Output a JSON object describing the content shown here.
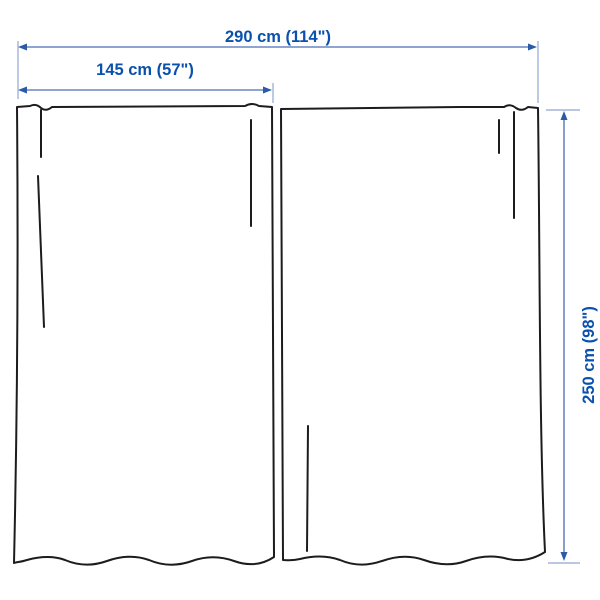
{
  "diagram": {
    "type": "product-dimension-illustration",
    "subject": "pair of curtain panels",
    "dimensions": {
      "total_width": {
        "label": "290 cm (114\")",
        "cm": 290,
        "inches": 114,
        "orientation": "horizontal"
      },
      "panel_width": {
        "label": "145 cm (57\")",
        "cm": 145,
        "inches": 57,
        "orientation": "horizontal"
      },
      "panel_height": {
        "label": "250 cm (98\")",
        "cm": 250,
        "inches": 98,
        "orientation": "vertical"
      }
    },
    "panels": [
      {
        "name": "left-curtain-panel"
      },
      {
        "name": "right-curtain-panel"
      }
    ],
    "colors": {
      "background": "#ffffff",
      "panel_outline": "#1c1c1c",
      "dimension_text": "#0a51ad",
      "dimension_line": "#6c86c4",
      "dimension_arrow": "#2a5aa8",
      "extension_line": "#a3b4d8"
    }
  }
}
